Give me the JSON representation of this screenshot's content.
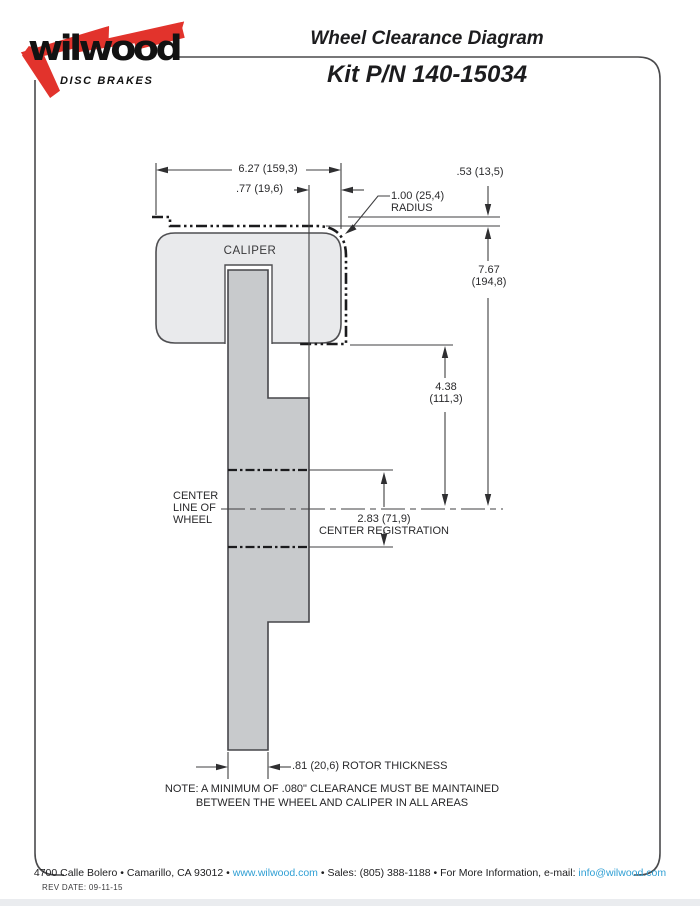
{
  "logo": {
    "brand": "wilwood",
    "tagline": "DISC BRAKES",
    "red": "#e2332c"
  },
  "header": {
    "title": "Wheel Clearance Diagram",
    "kit": "Kit P/N 140-15034"
  },
  "diagram": {
    "caliper_label": "CALIPER",
    "dim_width": "6.27 (159,3)",
    "dim_overhang": ".77 (19,6)",
    "dim_radius_line1": "1.00 (25,4)",
    "dim_radius_line2": "RADIUS",
    "dim_lip": ".53 (13,5)",
    "dim_height_line1": "7.67",
    "dim_height_line2": "(194,8)",
    "dim_mount_line1": "4.38",
    "dim_mount_line2": "(111,3)",
    "centerline_line1": "CENTER",
    "centerline_line2": "LINE OF",
    "centerline_line3": "WHEEL",
    "dim_registration": "2.83 (71,9)",
    "registration_label": "CENTER REGISTRATION",
    "dim_rotor": ".81 (20,6) ROTOR THICKNESS",
    "note_line1": "NOTE: A MINIMUM OF .080\" CLEARANCE MUST BE MAINTAINED",
    "note_line2": "BETWEEN THE WHEEL AND CALIPER IN ALL AREAS"
  },
  "footer": {
    "address": "4700 Calle Bolero",
    "city": "Camarillo, CA 93012",
    "website": "www.wilwood.com",
    "sales": "Sales: (805) 388-1188",
    "info_prefix": "For More Information, e-mail:",
    "email": "info@wilwood.com",
    "separator": "•",
    "rev_date": "REV DATE:  09-11-15",
    "link_color": "#2f9fd4"
  }
}
